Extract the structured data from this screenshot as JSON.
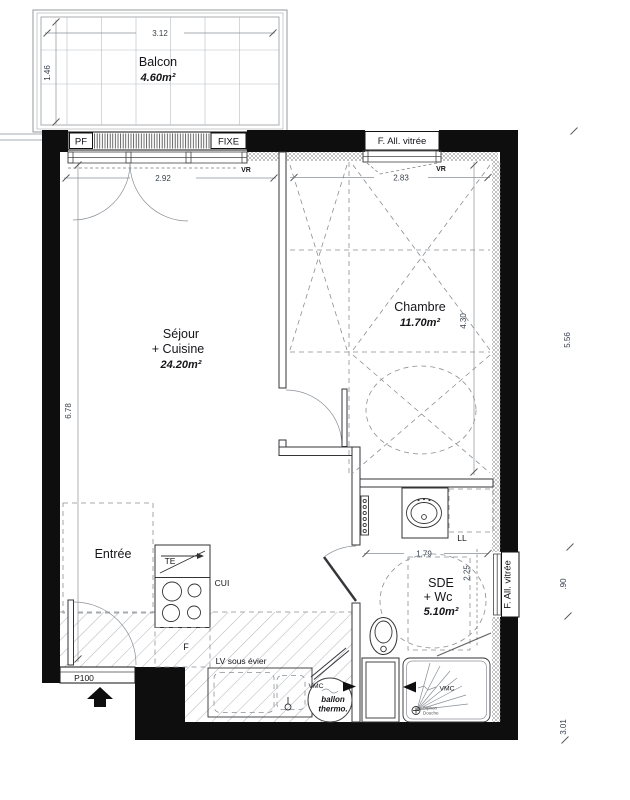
{
  "labels": {
    "balcon": "Balcon",
    "balcon_area": "4.60m²",
    "sejour1": "Séjour",
    "sejour2": "+ Cuisine",
    "sejour_area": "24.20m²",
    "chambre": "Chambre",
    "chambre_area": "11.70m²",
    "entree": "Entrée",
    "sde1": "SDE",
    "sde2": "+ Wc",
    "sde_area": "5.10m²"
  },
  "dims": {
    "balcony_width": "3.12",
    "balcony_depth": "1.46",
    "sejour_window": "2.92",
    "chambre_window": "2.83",
    "sejour_depth": "6.78",
    "chambre_depth": "4.30",
    "sde_width": "1.79",
    "sde_depth": "2.25",
    "right_top": "5.56",
    "right_window": ".90",
    "right_bottom": "3.01"
  },
  "openings": {
    "pf": "PF",
    "fixe": "FIXE",
    "top_window_label": "F. All. vitrée",
    "side_window_label": "F. All. vitrée",
    "vr_left": "VR",
    "vr_right": "VR",
    "entry_door": "P100"
  },
  "equip": {
    "te": "TE",
    "cui": "CUI",
    "fridge": "F",
    "lv": "LV sous évier",
    "vmc_kitchen": "VMC",
    "vmc_shower": "VMC",
    "ballon1": "ballon",
    "ballon2": "thermo.",
    "ll": "LL",
    "siphon1": "Siphon",
    "siphon2": "Douche"
  },
  "colors": {
    "wall": "#0e0e0e",
    "dim_text": "#38404c",
    "background": "#ffffff"
  }
}
